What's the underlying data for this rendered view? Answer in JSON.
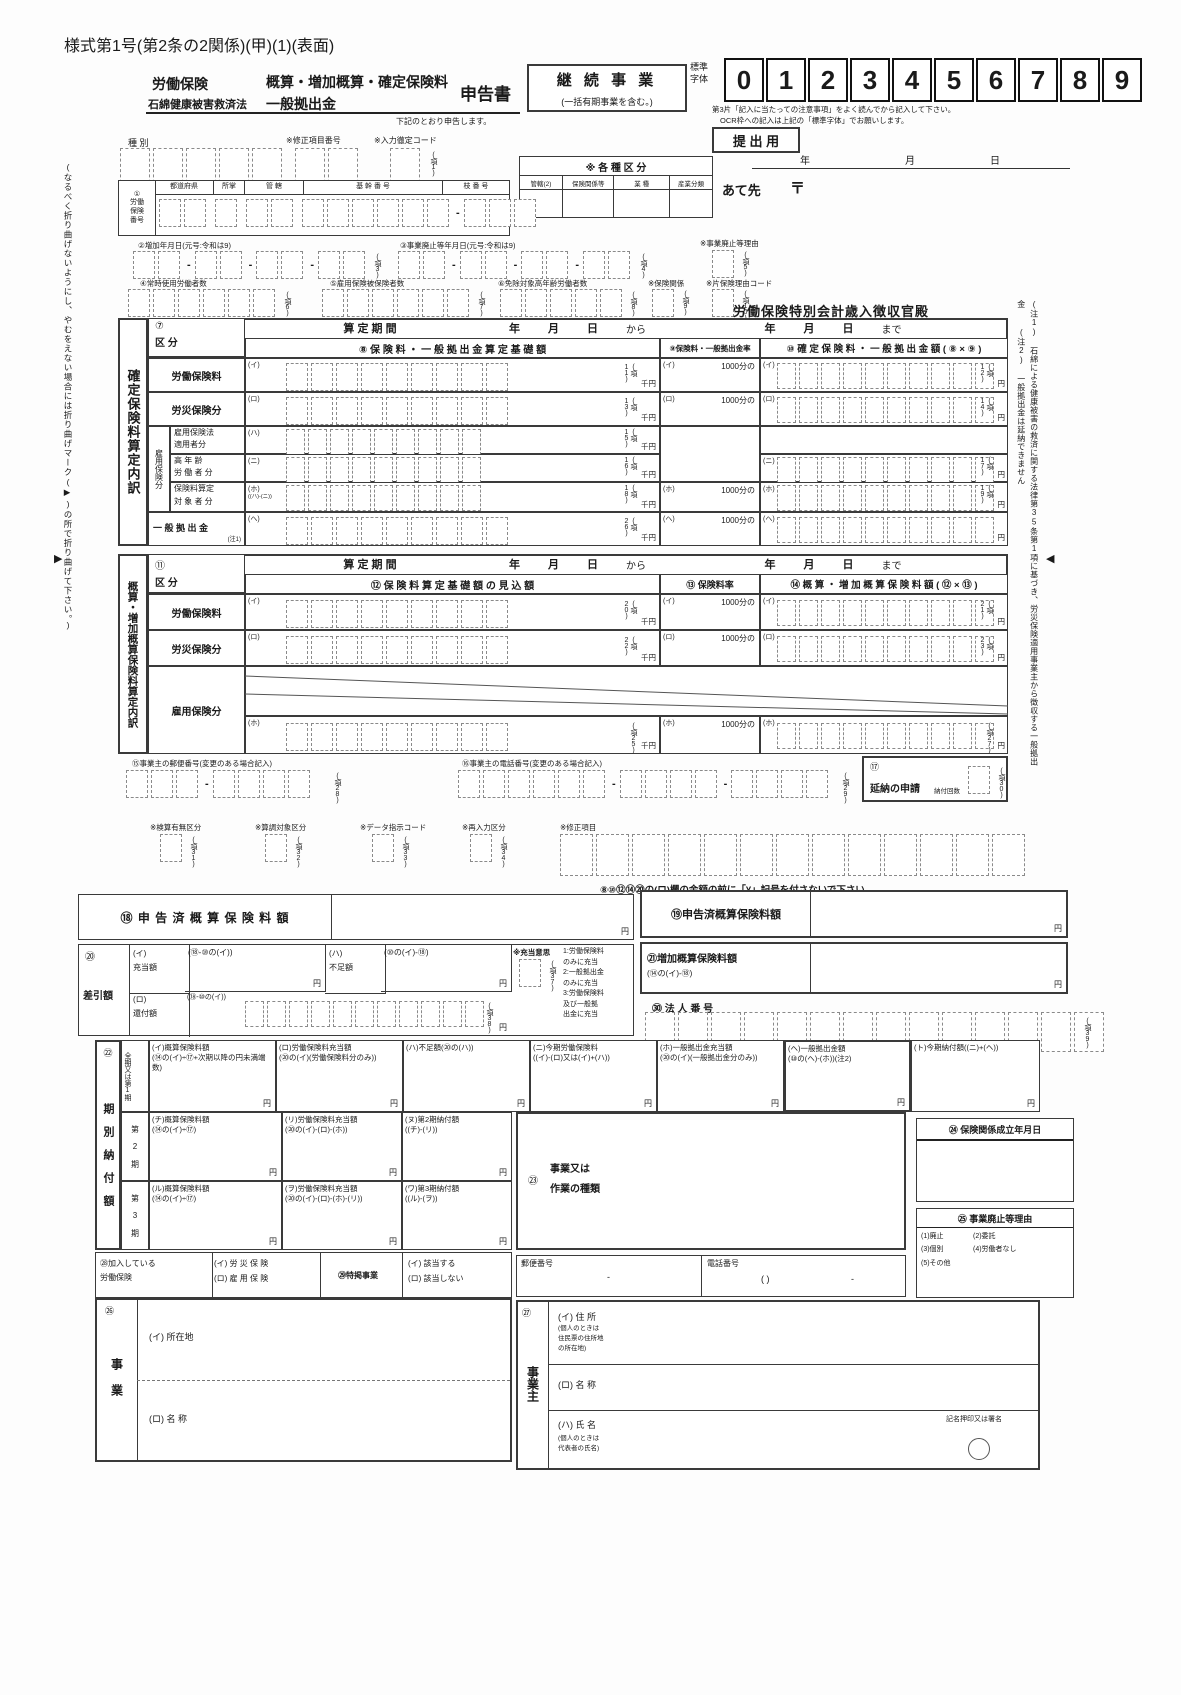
{
  "c": {
    "dash": "-",
    "yen": "円",
    "sen_yen": "千円",
    "rate": "1000分の",
    "year": "年",
    "month": "月",
    "day": "日",
    "kara": "から",
    "made": "まで",
    "santei": "算 定 期 間"
  },
  "title": "様式第1号(第2条の2関係)(甲)(1)(表面)",
  "header": {
    "insurance": "労働保険",
    "law": "石綿健康被害救済法",
    "main1": "概算・増加概算・確定保険料",
    "main2": "一般拠出金",
    "form_name": "申告書",
    "declare": "下記のとおり申告します。",
    "keizoku": "継 続 事 業",
    "keizoku_sub": "(一括有期事業を含む。)",
    "std1": "標準",
    "std2": "字体",
    "digits": [
      "0",
      "1",
      "2",
      "3",
      "4",
      "5",
      "6",
      "7",
      "8",
      "9"
    ],
    "note1": "第3片「記入に当たっての注意事項」をよく読んでから記入して下さい。",
    "note2": "OCR枠への記入は上記の「標準字体」でお願いします。",
    "submit": "提 出 用",
    "atesaki": "あて先",
    "postal": "〒",
    "kubun": {
      "title": "※ 各 種 区 分",
      "cols": [
        "管轄(2)",
        "保険関係等",
        "業  種",
        "産業分類"
      ]
    }
  },
  "top": {
    "shubetsu": "種   別",
    "shusei": "※修正項目番号",
    "nyuryoku": "※入力徹定コード",
    "ko1": "(項1)",
    "rouho": {
      "num": "①",
      "l1": "労働",
      "l2": "保険",
      "l3": "番号",
      "cols": [
        "都道府県",
        "所掌",
        "管  轄",
        "基  幹  番  号",
        "枝  番  号"
      ],
      "ko2": "(項2)"
    },
    "z2": "②増加年月日(元号:令和は9)",
    "ko3": "(項3)",
    "z3": "③事業廃止等年月日(元号:令和は9)",
    "ko4": "(項4)",
    "z_riyu": "※事業廃止等理由",
    "ko5": "(項5)",
    "z4": "④常時使用労働者数",
    "ko6": "(項6)",
    "z5": "⑤雇用保険被保険者数",
    "ko7": "(項7)",
    "z6": "⑥免除対象高年齢労働者数",
    "ko8": "(項8)",
    "hokankei": "※保険関係",
    "ko9": "(項9)",
    "kata": "※片保険理由コード",
    "ko10": "(項10)",
    "tosyukan": "労働保険特別会計歳入徴収官殿"
  },
  "k7": {
    "side": "確定保険料算定内訳",
    "num": "⑦",
    "kubun": "区   分",
    "col8": "⑧ 保 険 料 ・ 一 般 拠 出 金 算 定 基 礎 額",
    "col9": "⑨保険料・一般拠出金率",
    "col10": "⑩ 確 定 保 険 料 ・ 一 般 拠 出 金 額 ( ⑧ × ⑨ )",
    "koyou_side": "雇用保険分",
    "rows": [
      {
        "label": "労働保険料",
        "m8": "(イ)",
        "ko8": "(項11)",
        "m9": "(イ)",
        "m10": "(イ)",
        "ko10": "(項12)"
      },
      {
        "label": "労災保険分",
        "m8": "(ロ)",
        "ko8": "(項13)",
        "m9": "(ロ)",
        "m10": "(ロ)",
        "ko10": "(項14)"
      },
      {
        "l1": "雇用保険法",
        "l2": "適用者分",
        "m8": "(ハ)",
        "ko8": "(項15)"
      },
      {
        "l1": "高 年 齢",
        "l2": "労 働 者 分",
        "m8": "(ニ)",
        "ko8": "(項16)",
        "m10": "(ニ)",
        "ko10": "(項17)"
      },
      {
        "l1": "保険料算定",
        "l2": "対 象 者 分",
        "m8": "(ホ)",
        "sub": "((ハ)-(ニ))",
        "ko8": "(項18)",
        "m9": "(ホ)",
        "m10": "(ホ)",
        "ko10": "(項19)"
      },
      {
        "label": "一 般 拠 出 金",
        "note": "(注1)",
        "m8": "(ヘ)",
        "ko8": "(項26)",
        "m9": "(ヘ)",
        "m10": "(ヘ)"
      }
    ]
  },
  "k11": {
    "side": "概算・増加概算保険料算定内訳",
    "num": "⑪",
    "kubun": "区   分",
    "col12": "⑫ 保 険 料 算 定 基 礎 額 の 見 込 額",
    "col13": "⑬ 保険料率",
    "col14": "⑭ 概 算 ・ 増 加 概 算 保 険 料 額 ( ⑫ × ⑬ )",
    "rows": [
      {
        "label": "労働保険料",
        "m12": "(イ)",
        "ko12": "(項20)",
        "m13": "(イ)",
        "m14": "(イ)",
        "ko14": "(項21)"
      },
      {
        "label": "労災保険分",
        "m12": "(ロ)",
        "ko12": "(項22)",
        "m13": "(ロ)",
        "m14": "(ロ)",
        "ko14": "(項23)"
      },
      {
        "label": "雇用保険分",
        "m12": "(ホ)",
        "ko12": "(項25)",
        "m13": "(ホ)",
        "m14": "(ホ)",
        "ko14": "(項27)"
      }
    ]
  },
  "mid": {
    "z15": "⑮事業主の郵便番号(変更のある場合記入)",
    "ko28": "(項28)",
    "z16": "⑯事業主の電話番号(変更のある場合記入)",
    "ko29": "(項29)",
    "z17n": "⑰",
    "z17": "延納の申請",
    "z17s": "納付回数",
    "ko30": "(項30)",
    "kensan": "※検算有無区分",
    "ko31": "(項31)",
    "sancho": "※算調対象区分",
    "ko32": "(項32)",
    "dshiji": "※データ指示コード",
    "ko33": "(項33)",
    "sainyu": "※再入力区分",
    "ko34": "(項34)",
    "shusei2": "※修正項目",
    "yen_note": "⑧⑩⑫⑭⑳の(ロ)欄の金額の前に「¥」記号を付さないで下さい。"
  },
  "k18": {
    "label": "⑱ 申 告 済 概 算 保 険 料 額"
  },
  "k19": {
    "label": "⑲申告済概算保険料額"
  },
  "k20": {
    "num": "⑳",
    "label": "差引額",
    "i": "(イ)",
    "i2": "充当額",
    "i_f": "(⑱-⑩の(イ))",
    "ha": "(ハ)",
    "ha2": "不足額",
    "ha_f": "(⑩の(イ)-⑱)",
    "juto": "※充当意思",
    "ko37": "(項37)",
    "opts": [
      "1:労働保険料",
      "  のみに充当",
      "2:一般拠出金",
      "  のみに充当",
      "3:労働保険料",
      "  及び一般拠",
      "  出金に充当"
    ],
    "ro": "(ロ)",
    "ro2": "還付額",
    "ro_f": "(⑱-⑩の(イ))",
    "ko38": "(項38)"
  },
  "k21": {
    "label": "㉑増加概算保険料額",
    "sub": "(⑭の(イ)-⑱)"
  },
  "houjin": {
    "label": "㉚ 法 人 番 号",
    "ko39": "(項39)"
  },
  "k22": {
    "num": "㉒",
    "side": "期 別 納 付 額",
    "r1a": "全期又は",
    "r1b": "第1期",
    "r2": "第 2 期",
    "r3": "第 3 期",
    "row1": [
      {
        "t": "(イ)概算保険料額",
        "s": "(⑭の(イ)÷⑰+次期以降の円未満端数)"
      },
      {
        "t": "(ロ)労働保険料充当額",
        "s": "(⑳の(イ)(労働保険料分のみ))"
      },
      {
        "t": "(ハ)不足額(⑳の(ハ))",
        "s": ""
      },
      {
        "t": "(ニ)今期労働保険料",
        "s": "((イ)-(ロ)又は(イ)+(ハ))"
      },
      {
        "t": "(ホ)一般拠出金充当額",
        "s": "(⑳の(イ)(一般拠出金分のみ))"
      },
      {
        "t": "(ヘ)一般拠出金額",
        "s": "(⑩の(ヘ)-(ホ))(注2)"
      },
      {
        "t": "(ト)今期納付額((ニ)+(ヘ))",
        "s": ""
      }
    ],
    "row2": [
      {
        "t": "(チ)概算保険料額",
        "s": "(⑭の(イ)÷⑰)"
      },
      {
        "t": "(リ)労働保険料充当額",
        "s": "(⑳の(イ)-(ロ)-(ホ))"
      },
      {
        "t": "(ヌ)第2期納付額",
        "s": "((チ)-(リ))"
      }
    ],
    "row3": [
      {
        "t": "(ル)概算保険料額",
        "s": "(⑭の(イ)÷⑰)"
      },
      {
        "t": "(ヲ)労働保険料充当額",
        "s": "(⑳の(イ)-(ロ)-(ホ)-(リ))"
      },
      {
        "t": "(ワ)第3期納付額",
        "s": "((ル)-(ヲ))"
      }
    ]
  },
  "k23": {
    "num": "㉓",
    "l1": "事業又は",
    "l2": "作業の種類"
  },
  "k24": {
    "label": "㉔ 保険関係成立年月日"
  },
  "k25": {
    "label": "㉕ 事業廃止等理由",
    "o1": "(1)廃止",
    "o2": "(2)委託",
    "o3": "(3)個別",
    "o4": "(4)労働者なし",
    "o5": "(5)その他"
  },
  "postal": {
    "yubin": "郵便番号",
    "tel": "電話番号",
    "paren": "(        )"
  },
  "k28": {
    "l1": "㉘加入している",
    "l2": "労働保険",
    "rosai": "(イ) 労 災 保 険",
    "koyou": "(ロ) 雇 用 保 険",
    "num29": "㉙特掲事業",
    "ok": "(イ) 該当する",
    "ng": "(ロ) 該当しない"
  },
  "k26": {
    "num": "㉖",
    "side": "事  業",
    "i": "(イ) 所在地",
    "ro": "(ロ) 名  称"
  },
  "k27": {
    "num": "㉗",
    "side": "事業主",
    "i": "(イ) 住  所",
    "i_note1": "(個人のときは",
    "i_note2": "住民票の住所地",
    "i_note3": "の所在地)",
    "ro": "(ロ) 名  称",
    "ha": "(ハ) 氏  名",
    "ha_note1": "(個人のときは",
    "ha_note2": "代表者の氏名)",
    "sign": "記名押印又は署名"
  },
  "margins": {
    "left": "(なるべく折り曲げないようにし、やむをえない場合には折り曲げマーク(▶)の所で折り曲げて下さい。)",
    "fold_left": "▶",
    "fold_right": "◀",
    "note1": "(注1) 石綿による健康被害の救済に関する法律第35条第1項に基づき、労災保険適用事業主から徴収する一般拠出金",
    "note2": "(注2) 一般拠出金は延納できません"
  }
}
